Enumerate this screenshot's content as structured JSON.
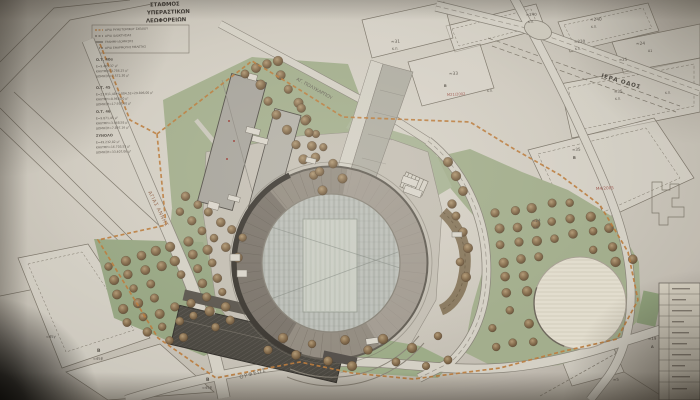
{
  "colors": {
    "paper": "#d3cdc1",
    "pencil": "#5a544b",
    "green_area": "#a3b08b",
    "grove_green": "#98a981",
    "tree_brown": "#8a6f4c",
    "boundary_orange": "#c17c36",
    "red_label": "#a3544b",
    "stadium_ring": "#948c80",
    "plaza_gray": "#c6c1b5",
    "building_gray": "#a9a59c",
    "dark_structure": "#4b4740",
    "white_plaza": "#e6e0cf"
  },
  "title_block": {
    "lines": [
      "ΣΤΑΘΜΟΣ",
      "ΥΠΕΡΑΣΤΙΚΩΝ",
      "ΛΕΩΦΟΡΕΙΩΝ"
    ]
  },
  "legend": {
    "items": [
      {
        "t": "ΟΡΙΟ ΡΥΜΟΤΟΜΙΚΟΥ ΣΧΕΔΙΟΥ",
        "x": 105,
        "y": 31,
        "s": 2.9
      },
      {
        "t": "ΟΡΙΟ ΙΔΙΟΚΤΗΣΙΑΣ",
        "x": 105,
        "y": 37,
        "s": 2.9
      },
      {
        "t": "ΓΡΑΜΜΗ ΔΟΜΗΣΗΣ",
        "x": 105,
        "y": 43,
        "s": 2.9
      },
      {
        "t": "ΟΡΙΟ ΕΦΑΡΜΟΓΗΣ ΜΕΛΕΤΗΣ",
        "x": 105,
        "y": 49,
        "s": 2.9
      }
    ]
  },
  "area_tables": [
    {
      "t": "Ο.Τ. 40α",
      "x": 96,
      "y": 61,
      "s": 3.6,
      "w": 1
    },
    {
      "t": "Ε=9.465,37 μ²",
      "x": 96,
      "y": 67.5,
      "s": 3
    },
    {
      "t": "ΚΑΛΥΨΗ=3.786,15 μ²",
      "x": 96,
      "y": 72.5,
      "s": 3
    },
    {
      "t": "ΔΟΜΗΣΗ=7.572,30 μ²",
      "x": 96,
      "y": 77.5,
      "s": 3
    },
    {
      "t": "Ο.Τ. 45",
      "x": 96,
      "y": 89,
      "s": 3.6,
      "w": 1
    },
    {
      "t": "Ε=23.811,48+6.084,52=29.896,00 μ²",
      "x": 96,
      "y": 95.5,
      "s": 3
    },
    {
      "t": "ΚΑΛΥΨΗ=8.968,80 μ²",
      "x": 96,
      "y": 100.5,
      "s": 3
    },
    {
      "t": "ΔΟΜΗΣΗ=17.937,60 μ²",
      "x": 96,
      "y": 105.5,
      "s": 3
    },
    {
      "t": "Ο.Τ. 46",
      "x": 96,
      "y": 113,
      "s": 3.6,
      "w": 1
    },
    {
      "t": "Ε=9.871,45 μ²",
      "x": 96,
      "y": 119.5,
      "s": 3
    },
    {
      "t": "ΚΑΛΥΨΗ=3.948,58 μ²",
      "x": 96,
      "y": 124.5,
      "s": 3
    },
    {
      "t": "ΔΟΜΗΣΗ=7.897,16 μ²",
      "x": 96,
      "y": 129.5,
      "s": 3
    },
    {
      "t": "ΣΥΝΟΛΟ",
      "x": 96,
      "y": 137,
      "s": 3.6,
      "w": 1
    },
    {
      "t": "Ε=49.232,82 μ²",
      "x": 96,
      "y": 143.5,
      "s": 3
    },
    {
      "t": "ΚΑΛΥΨΗ=16.703,53 μ²",
      "x": 96,
      "y": 148.5,
      "s": 3
    },
    {
      "t": "ΔΟΜΗΣΗ=33.407,06 μ²",
      "x": 96,
      "y": 153.5,
      "s": 3
    }
  ],
  "streets": [
    {
      "name": "ΑΓΙΑΣ ΑΝΝΗΣ"
    },
    {
      "name": "ΑΓ. ΠΟΛΥΚΑΡΠΟΥ"
    },
    {
      "name": "ΙΕΡΑ ΟΔΟΣ"
    },
    {
      "name": "ΟΡΦΕΩΣ"
    }
  ],
  "parcel_labels": [
    {
      "t": "≈31",
      "x": 391,
      "y": 43,
      "s": 4.3
    },
    {
      "t": "Κ.Π.",
      "x": 392,
      "y": 50,
      "s": 3.2
    },
    {
      "t": "≈33",
      "x": 449,
      "y": 75,
      "s": 4.3
    },
    {
      "t": "Β",
      "x": 444,
      "y": 87,
      "s": 3.6,
      "w": 1
    },
    {
      "t": "Μ21/2002",
      "x": 447,
      "y": 96,
      "s": 3.7,
      "c": 1,
      "r": -3
    },
    {
      "t": "≈240",
      "x": 526,
      "y": 16,
      "s": 3.9
    },
    {
      "t": "Κ.Π.",
      "x": 528,
      "y": 23,
      "s": 3
    },
    {
      "t": "≈240",
      "x": 590,
      "y": 21,
      "s": 4.3
    },
    {
      "t": "Κ.Π.",
      "x": 591,
      "y": 28,
      "s": 3
    },
    {
      "t": "≈230",
      "x": 574,
      "y": 43,
      "s": 4.1
    },
    {
      "t": "Κ.Π.",
      "x": 575,
      "y": 50,
      "s": 3
    },
    {
      "t": "≈24",
      "x": 636,
      "y": 45,
      "s": 4.3
    },
    {
      "t": "Α1",
      "x": 648,
      "y": 52,
      "s": 3.3
    },
    {
      "t": "≈25",
      "x": 619,
      "y": 61,
      "s": 3.9
    },
    {
      "t": "≈35",
      "x": 614,
      "y": 93,
      "s": 4.1
    },
    {
      "t": "Κ.Π.",
      "x": 615,
      "y": 100,
      "s": 3
    },
    {
      "t": "Κ.Π.",
      "x": 487,
      "y": 92,
      "s": 3
    },
    {
      "t": "Κ.Π.",
      "x": 665,
      "y": 94,
      "s": 3
    },
    {
      "t": "≈35",
      "x": 572,
      "y": 151,
      "s": 4.1
    },
    {
      "t": "Β",
      "x": 573,
      "y": 159,
      "s": 3.8,
      "w": 1
    },
    {
      "t": "Μ4/2005",
      "x": 596,
      "y": 190,
      "s": 4.1,
      "c": 1,
      "r": -3
    },
    {
      "t": "≈24",
      "x": 532,
      "y": 222,
      "s": 4.1
    },
    {
      "t": "Κ.Π.",
      "x": 533,
      "y": 229,
      "s": 3
    },
    {
      "t": "≈45γ",
      "x": 46,
      "y": 338,
      "s": 3.6
    },
    {
      "t": "Β",
      "x": 97,
      "y": 352,
      "s": 4.6,
      "w": 1
    },
    {
      "t": "≈45β",
      "x": 93,
      "y": 360,
      "s": 3.6
    },
    {
      "t": "Β",
      "x": 206,
      "y": 381,
      "s": 4.6,
      "w": 1
    },
    {
      "t": "≈45β",
      "x": 202,
      "y": 389,
      "s": 3.6
    },
    {
      "t": "≈19",
      "x": 648,
      "y": 340,
      "s": 4
    },
    {
      "t": "Α",
      "x": 651,
      "y": 348,
      "s": 3.6,
      "w": 1
    },
    {
      "t": "≈5",
      "x": 613,
      "y": 381,
      "s": 4
    }
  ]
}
